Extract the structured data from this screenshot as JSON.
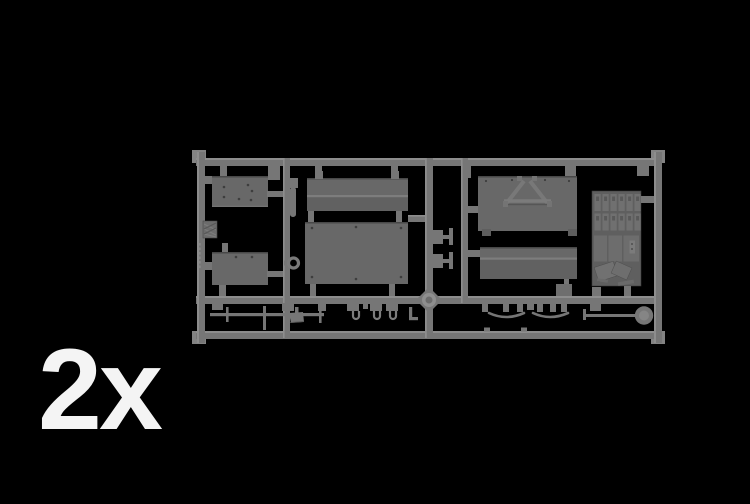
{
  "scene": {
    "description": "Grey injection-moulded model kit sprue (runner with flat vehicle panels and accessory parts) rendered on a black background",
    "quantity_label": "2x"
  },
  "colors": {
    "background": "#000000",
    "rail": "#767676",
    "rail_light": "#8d8d8d",
    "panel": "#686868",
    "panel_edge": "#484848",
    "detail_light": "#7d7d7d",
    "accessory_base": "#5f5f5f",
    "label": "#f4f4f4"
  },
  "sprue": {
    "material_color_name": "grey styrene",
    "left_rail_molded_text": "illegible raised lettering",
    "parts": [
      "riveted plate (upper left)",
      "riveted plate (lower left)",
      "diamond tread plate",
      "cylindrical pin",
      "towing ring",
      "ridged side panel (centre top)",
      "large riveted floor panel (centre)",
      "two small brackets (centre column)",
      "deck panel with folded A-frame legs",
      "ridged side panel (right)",
      "stowage panel with jerry cans, boxes and tarpaulins",
      "pioneer tool rod with axe and pins",
      "three U-clips",
      "small L-bracket",
      "hanger tabs",
      "two bow arcs",
      "round-blade shovel"
    ]
  }
}
